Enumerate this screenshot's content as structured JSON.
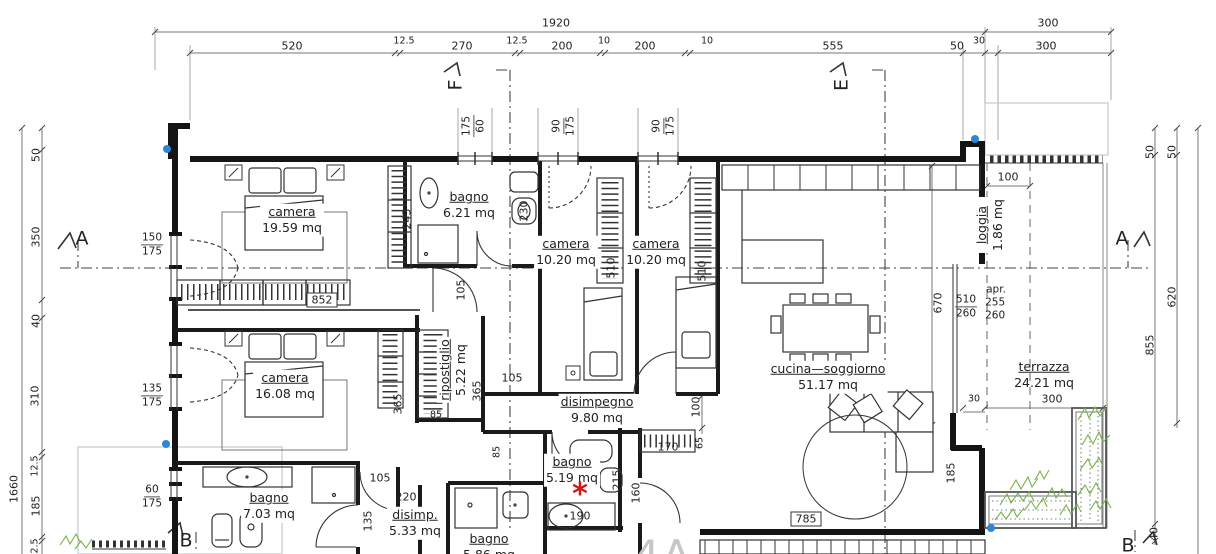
{
  "markers": {
    "a_left": "A",
    "a_right": "A",
    "b_left": "B",
    "b_right": "B",
    "e": "E",
    "f": "F",
    "unit_label": "4A",
    "apr_note": "apr.",
    "asterisk": "*"
  },
  "rooms": {
    "camera1": {
      "name": "camera",
      "area": "19.59 mq"
    },
    "bagno1": {
      "name": "bagno",
      "area": "6.21 mq"
    },
    "camera2": {
      "name": "camera",
      "area": "10.20 mq"
    },
    "camera3": {
      "name": "camera",
      "area": "10.20 mq"
    },
    "cucina": {
      "name": "cucina—soggiorno",
      "area": "51.17 mq"
    },
    "loggia": {
      "name": "loggia",
      "area": "1.86 mq"
    },
    "terrazza": {
      "name": "terrazza",
      "area": "24.21 mq"
    },
    "camera4": {
      "name": "camera",
      "area": "16.08 mq"
    },
    "ripostiglio": {
      "name": "ripostiglio",
      "area": "5.22 mq"
    },
    "disimpegno": {
      "name": "disimpegno",
      "area": "9.80 mq"
    },
    "bagno2": {
      "name": "bagno",
      "area": "5.19 mq"
    },
    "bagno3": {
      "name": "bagno",
      "area": "7.03 mq"
    },
    "disimp2": {
      "name": "disimp.",
      "area": "5.33 mq"
    },
    "bagno4": {
      "name": "bagno",
      "area": "5.86 mq"
    }
  },
  "dims": {
    "top": {
      "total": "1920",
      "right_total": "300",
      "row": [
        "520",
        "12.5",
        "270",
        "12.5",
        "200",
        "10",
        "200",
        "10",
        "555",
        "50",
        "30",
        "300"
      ]
    },
    "left": {
      "seg": [
        "50",
        "350",
        "40",
        "310",
        "12.5",
        "185",
        "2.5"
      ],
      "total": "1660"
    },
    "right": {
      "r50a": "50",
      "r50b": "50",
      "r620": "620",
      "r855": "855",
      "r40": "40"
    },
    "win": [
      {
        "a": "175",
        "b": "60"
      },
      {
        "a": "90",
        "b": "175"
      },
      {
        "a": "90",
        "b": "175"
      }
    ],
    "wall": [
      {
        "a": "150",
        "b": "175"
      },
      {
        "a": "135",
        "b": "175"
      },
      {
        "a": "60",
        "b": "175"
      }
    ],
    "in": {
      "w245": "245",
      "w230": "230",
      "rad852": "852",
      "c105a": "105",
      "c105b": "105",
      "c105c": "105",
      "w510a": "510",
      "w510b": "510",
      "w365a": "365",
      "w365b": "365",
      "w85a": "85",
      "w85b": "85",
      "h100": "100",
      "h170": "170",
      "h65": "65",
      "h215": "215",
      "h160": "160",
      "h190": "190",
      "h135": "135",
      "h220": "220",
      "k670": "670",
      "k510": "510",
      "k260": "260",
      "apr255": "255",
      "apr260": "260",
      "lg100": "100",
      "t300": "300",
      "t30": "30",
      "k785": "785",
      "k185": "185"
    }
  },
  "colors": {
    "line": "#1b1b1b",
    "dim": "#555555",
    "accent_blue": "#2e86d6",
    "accent_red": "#d21717",
    "plant": "#76b24a",
    "muted": "#c6c6c6"
  }
}
